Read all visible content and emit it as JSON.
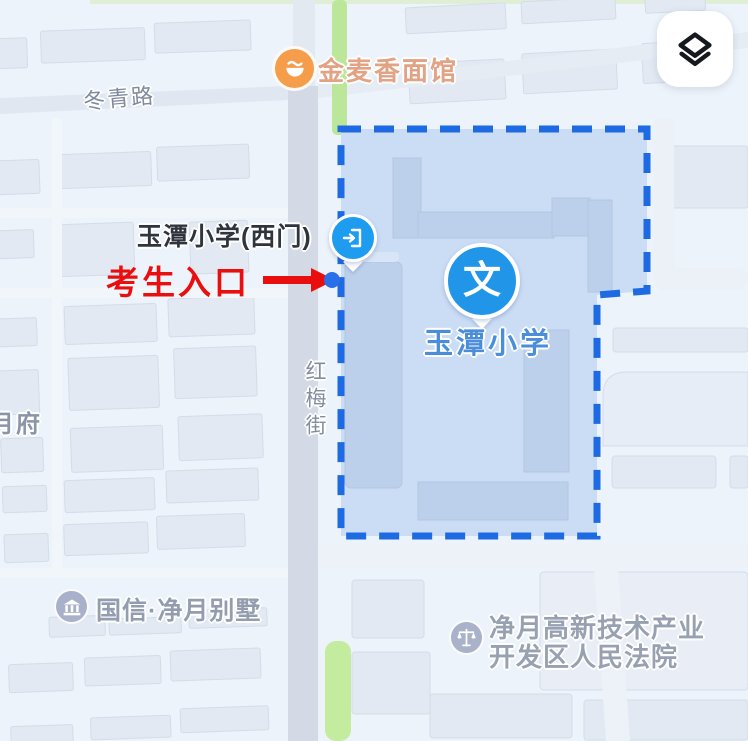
{
  "labels": {
    "noodle_shop": "金麦香面馆",
    "dongqing_road": "冬青路",
    "school_west_gate": "玉潭小学(西门)",
    "examinee_entrance": "考生入口",
    "school_name": "玉潭小学",
    "school_marker_glyph": "文",
    "hongmei_street": "红梅街",
    "partial_label": "月府",
    "villa": "国信·净月别墅",
    "court": "净月高新技术产业\n开发区人民法院"
  },
  "icons": {
    "layers_button": "layers-icon",
    "noodle_shop": "restaurant-icon",
    "school_gate_pin": "entrance-door-icon",
    "school_pin": "education-wen-icon",
    "villa": "building-icon",
    "court": "scales-icon",
    "annotation_arrow": "right-arrow-icon",
    "entrance_point": "blue-dot"
  },
  "colors": {
    "boundary_blue": "#1d6ae3",
    "boundary_fill": "#cbddf5",
    "pin_blue": "#2196e9",
    "gate_pin_blue": "#1e9cf0",
    "school_label_blue": "#4a8edb",
    "annotation_red": "#ea0f0f",
    "poi_orange": "#f59d4a",
    "poi_gray_blue": "#a8b1c9",
    "green_path": "#bfe99d",
    "road_gray": "#d3dae5",
    "background": "#edf3fa"
  }
}
